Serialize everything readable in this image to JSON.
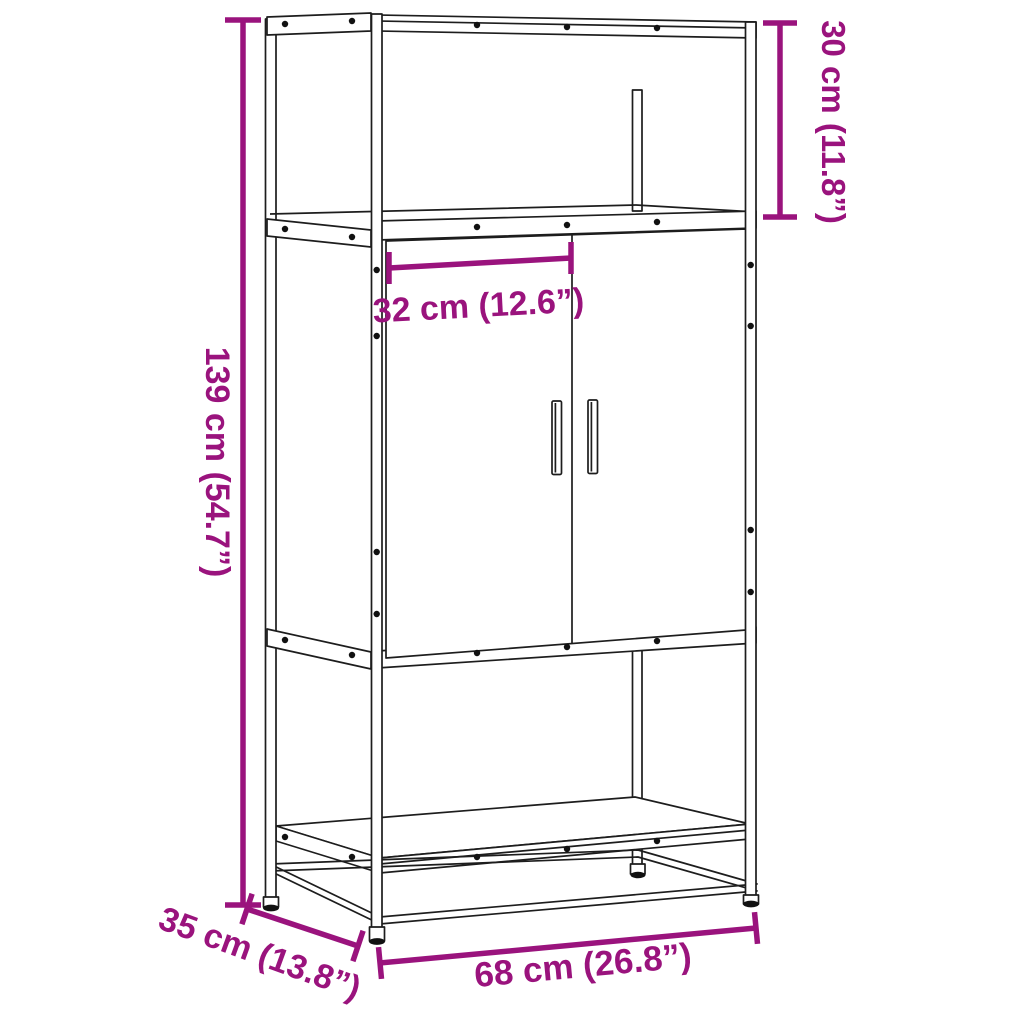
{
  "diagram": {
    "kind": "furniture-dimension-line-drawing",
    "product": "highboard cabinet with 2 doors, open top compartment and open base shelf",
    "accent_color": "#9A137D",
    "line_color": "#1d1d1d",
    "background_color": "#ffffff",
    "parts": [
      "top-frame",
      "open-top-compartment",
      "two-doors",
      "door-handles",
      "open-base-compartment",
      "base-shelf",
      "floor-frame",
      "adjustable-feet",
      "rivets"
    ]
  },
  "dimensions": {
    "total_height": {
      "label": "139 cm (54.7”)",
      "cm": 139,
      "inches": 54.7,
      "measures": "total height",
      "orientation": "vertical-left"
    },
    "top_section_height": {
      "label": "30 cm (11.8”)",
      "cm": 30,
      "inches": 11.8,
      "measures": "open top compartment height",
      "orientation": "vertical-right"
    },
    "door_width": {
      "label": "32 cm (12.6”)",
      "cm": 32,
      "inches": 12.6,
      "measures": "single door width",
      "orientation": "horizontal-middle"
    },
    "depth": {
      "label": "35 cm (13.8”)",
      "cm": 35,
      "inches": 13.8,
      "measures": "depth",
      "orientation": "diagonal-bottom-left"
    },
    "width": {
      "label": "68 cm (26.8”)",
      "cm": 68,
      "inches": 26.8,
      "measures": "total width",
      "orientation": "horizontal-bottom"
    }
  }
}
